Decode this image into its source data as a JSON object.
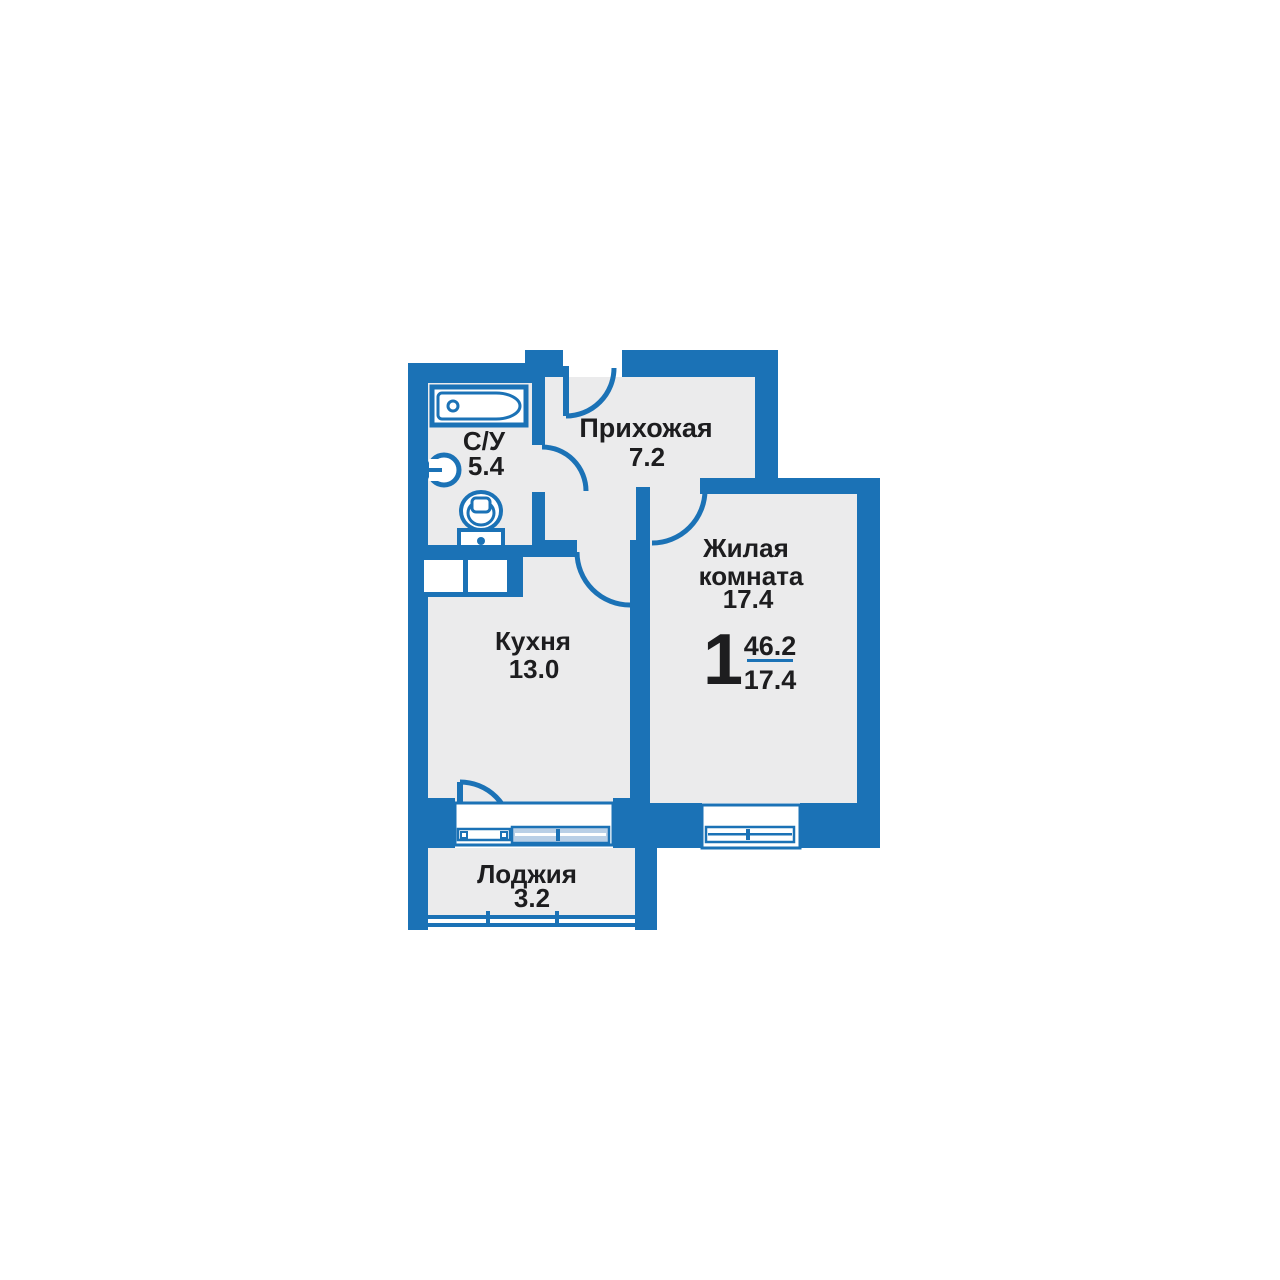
{
  "colors": {
    "wall": "#1b72b6",
    "room_fill": "#ebebec",
    "glazing": "#b9cfe6",
    "text": "#1d1d1f",
    "white": "#ffffff"
  },
  "figure": {
    "rooms_count": "1",
    "total_area": "46.2",
    "living_area": "17.4"
  },
  "rooms": {
    "bathroom": {
      "name": "С/У",
      "area": "5.4"
    },
    "hallway": {
      "name": "Прихожая",
      "area": "7.2"
    },
    "living": {
      "name_line1": "Жилая",
      "name_line2": "комната",
      "area": "17.4"
    },
    "kitchen": {
      "name": "Кухня",
      "area": "13.0"
    },
    "loggia": {
      "name": "Лоджия",
      "area": "3.2"
    }
  }
}
